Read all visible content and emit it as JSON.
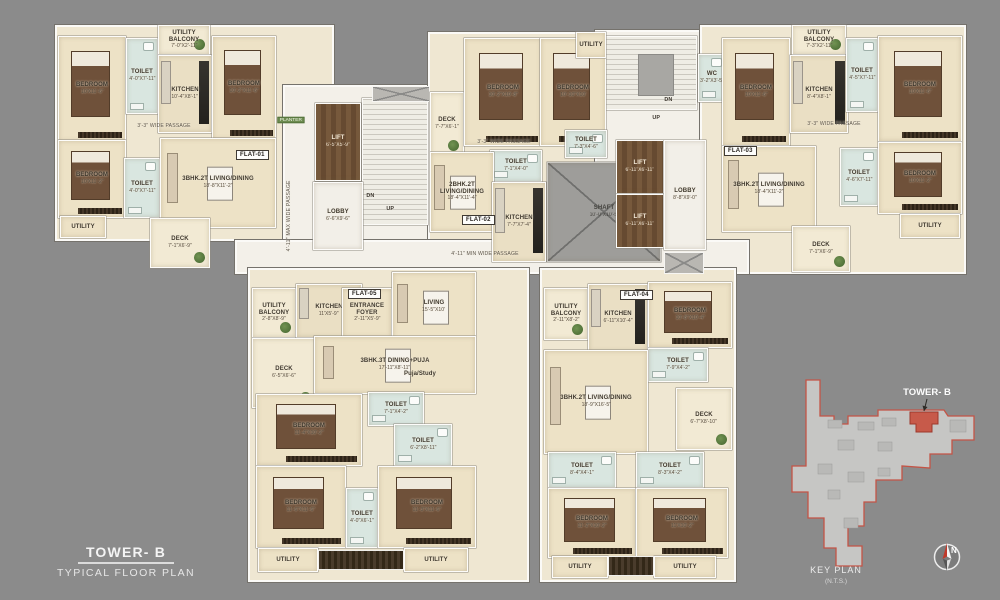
{
  "title": {
    "tower": "TOWER- B",
    "subtitle": "TYPICAL FLOOR PLAN"
  },
  "key_plan": {
    "heading": "KEY PLAN",
    "nts": "(N.T.S.)",
    "tower_label": "TOWER- B",
    "compass_n": "N",
    "highlight_color": "#c75a4a"
  },
  "colors": {
    "background": "#8b8b8b",
    "floor": "#ede2c6",
    "toilet": "#d9e6e0",
    "lift_wood": "#6d5138",
    "accent_red": "#c75a4a"
  },
  "passages": {
    "spine": "4'-11\" MIN WIDE PASSAGE",
    "left_vertical": "4'-11\" MAX WIDE PASSAGE",
    "wing_left": "3'-3\" WIDE PASSAGE",
    "wing_center": "3'-3\" WIDE PASSAGE",
    "wing_right": "3'-3\" WIDE PASSAGE"
  },
  "circulation": {
    "planter": "PLANTER",
    "lift1": {
      "name": "LIFT",
      "dims": "6'-5\"X5'-9\""
    },
    "lobby1": {
      "name": "LOBBY",
      "dims": "6'-6\"X9'-6\""
    },
    "stairs1": {
      "dn": "DN",
      "up": "UP"
    },
    "stairs2": {
      "dn": "DN",
      "up": "UP"
    },
    "wc": {
      "name": "WC",
      "dims": "3'-2\"X3'-5\""
    },
    "lift2": {
      "name": "LIFT",
      "dims": "6'-11\"X6'-11\""
    },
    "lift3": {
      "name": "LIFT",
      "dims": "6'-11\"X6'-11\""
    },
    "lobby2": {
      "name": "LOBBY",
      "dims": "8'-8\"X9'-0\""
    },
    "shaft": {
      "name": "SHAFT",
      "dims": "10'-0\"X10'-5\""
    }
  },
  "flats": {
    "flat01": {
      "badge": "FLAT-01",
      "rooms": {
        "bedroom1": {
          "name": "BEDROOM",
          "dims": "10'X11'-6\""
        },
        "toilet1": {
          "name": "TOILET",
          "dims": "4'-0\"X7'-11\""
        },
        "utility_balcony": {
          "name": "UTILITY BALCONY",
          "dims": "7'-0\"X2'-11\""
        },
        "kitchen": {
          "name": "KITCHEN",
          "dims": "10'-4\"X8'-1\""
        },
        "bedroom2": {
          "name": "BEDROOM",
          "dims": "10'-2\"X11'-6\""
        },
        "bedroom3": {
          "name": "BEDROOM",
          "dims": "10'X11'-2\""
        },
        "toilet2": {
          "name": "TOILET",
          "dims": "4'-0\"X7'-11\""
        },
        "living": {
          "name": "3BHK.2T LIVING/DINING",
          "dims": "18'-8\"X11'-2\""
        },
        "utility": {
          "name": "UTILITY"
        },
        "deck": {
          "name": "DECK",
          "dims": "7'-1\"X6'-9\""
        }
      }
    },
    "flat02": {
      "badge": "FLAT-02",
      "rooms": {
        "deck": {
          "name": "DECK",
          "dims": "7'-7\"X6'-1\""
        },
        "bedroom1": {
          "name": "BEDROOM",
          "dims": "10'-2\"X10'-8\""
        },
        "bedroom2": {
          "name": "BEDROOM",
          "dims": "10'-10\"X10'"
        },
        "utility": {
          "name": "UTILITY"
        },
        "toilet1": {
          "name": "TOILET",
          "dims": "7'-1\"X4'-0\""
        },
        "toilet2": {
          "name": "TOILET",
          "dims": "7'-3\"X4'-6\""
        },
        "living": {
          "name": "2BHK.2T LIVING/DINING",
          "dims": "18'-4\"X11'-4\""
        },
        "kitchen": {
          "name": "KITCHEN",
          "dims": "7'-7\"X7'-4\""
        }
      }
    },
    "flat03": {
      "badge": "FLAT-03",
      "rooms": {
        "bedroom1": {
          "name": "BEDROOM",
          "dims": "10'X11'-6\""
        },
        "utility_balcony": {
          "name": "UTILITY BALCONY",
          "dims": "7'-3\"X2'-11\""
        },
        "kitchen": {
          "name": "KITCHEN",
          "dims": "8'-4\"X8'-1\""
        },
        "toilet1": {
          "name": "TOILET",
          "dims": "4'-5\"X7'-11\""
        },
        "bedroom2": {
          "name": "BEDROOM",
          "dims": "10'X11'-6\""
        },
        "living": {
          "name": "3BHK.2T LIVING/DINING",
          "dims": "18'-4\"X11'-2\""
        },
        "toilet2": {
          "name": "TOILET",
          "dims": "4'-6\"X7'-11\""
        },
        "bedroom3": {
          "name": "BEDROOM",
          "dims": "10'X11'-2\""
        },
        "utility": {
          "name": "UTILITY"
        },
        "deck": {
          "name": "DECK",
          "dims": "7'-1\"X6'-9\""
        }
      }
    },
    "flat04": {
      "badge": "FLAT-04",
      "rooms": {
        "utility_balcony": {
          "name": "UTILITY BALCONY",
          "dims": "2'-11\"X8'-2\""
        },
        "kitchen": {
          "name": "KITCHEN",
          "dims": "6'-11\"X10'-4\""
        },
        "bedroom1": {
          "name": "BEDROOM",
          "dims": "10'-8\"X10'-4\""
        },
        "toilet1": {
          "name": "TOILET",
          "dims": "7'-9\"X4'-2\""
        },
        "living": {
          "name": "3BHK.2T LIVING/DINING",
          "dims": "18'-9\"X16'-5\""
        },
        "deck": {
          "name": "DECK",
          "dims": "6'-7\"X8'-10\""
        },
        "toilet2": {
          "name": "TOILET",
          "dims": "8'-4\"X4'-1\""
        },
        "toilet3": {
          "name": "TOILET",
          "dims": "8'-3\"X4'-2\""
        },
        "bedroom2": {
          "name": "BEDROOM",
          "dims": "11'-2\"X10'-2\""
        },
        "bedroom3": {
          "name": "BEDROOM",
          "dims": "11'X10'-2\""
        },
        "utility1": {
          "name": "UTILITY"
        },
        "utility2": {
          "name": "UTILITY"
        }
      }
    },
    "flat05": {
      "badge": "FLAT-05",
      "rooms": {
        "utility_balcony": {
          "name": "UTILITY BALCONY",
          "dims": "2'-8\"X8'-9\""
        },
        "kitchen": {
          "name": "KITCHEN",
          "dims": "11'X5'-9\""
        },
        "foyer": {
          "name": "ENTRANCE FOYER",
          "dims": "2'-11\"X5'-9\""
        },
        "living": {
          "name": "LIVING",
          "dims": "15'-5\"X10'"
        },
        "deck": {
          "name": "DECK",
          "dims": "6'-5\"X6'-6\""
        },
        "dining": {
          "name": "3BHK.3T DINING+PUJA",
          "dims": "17'-11\"X8'-11\""
        },
        "puja": {
          "name": "Puja/Study"
        },
        "toilet1": {
          "name": "TOILET",
          "dims": "7'-1\"X4'-2\""
        },
        "toilet2": {
          "name": "TOILET",
          "dims": "6'-2\"X8'-11\""
        },
        "bedroom1": {
          "name": "BEDROOM",
          "dims": "11'-4\"X10'-2\""
        },
        "bedroom2": {
          "name": "BEDROOM",
          "dims": "11'-6\"X11'-6\""
        },
        "toilet3": {
          "name": "TOILET",
          "dims": "4'-0\"X6'-1\""
        },
        "bedroom3": {
          "name": "BEDROOM",
          "dims": "11'-3\"X11'-6\""
        },
        "utility1": {
          "name": "UTILITY"
        },
        "utility2": {
          "name": "UTILITY"
        }
      }
    }
  }
}
